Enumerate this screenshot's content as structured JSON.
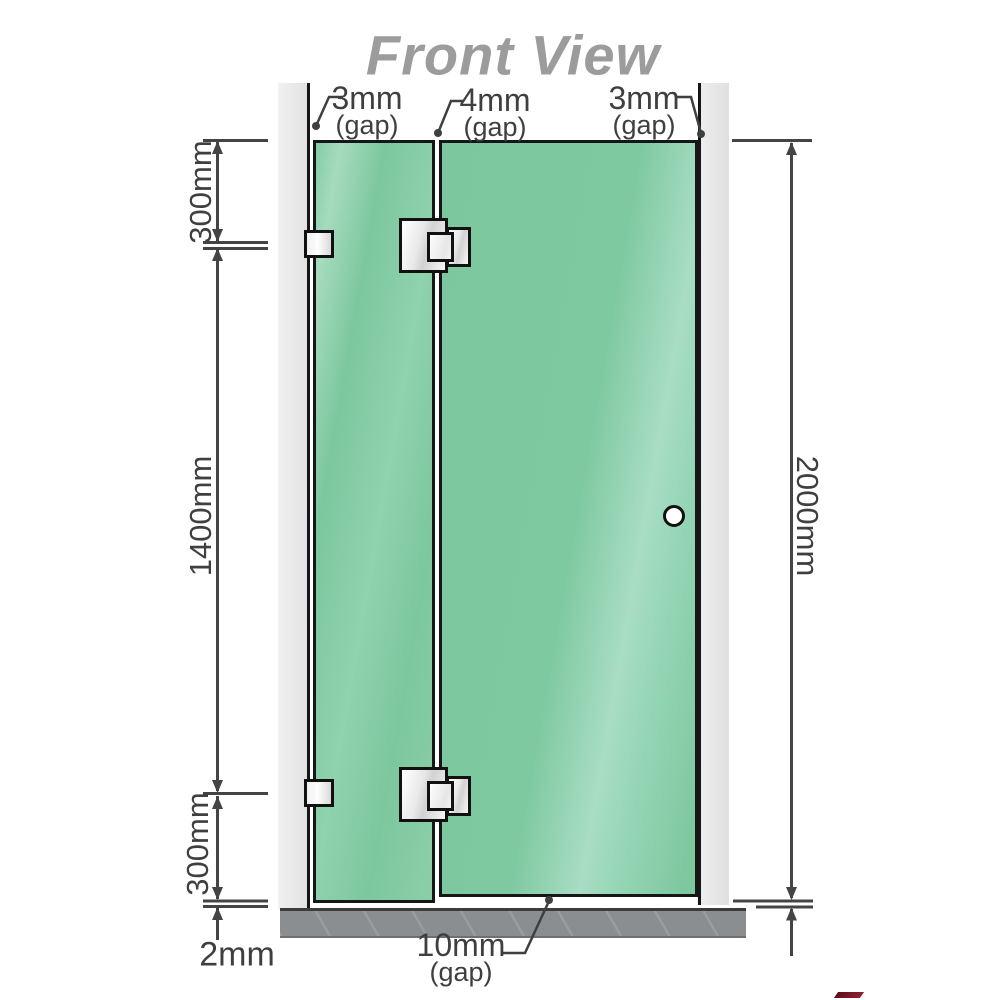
{
  "title": "Front View",
  "labels": {
    "gap_top_left": {
      "value": "3mm",
      "suffix": "(gap)"
    },
    "gap_top_middle": {
      "value": "4mm",
      "suffix": "(gap)"
    },
    "gap_top_right": {
      "value": "3mm",
      "suffix": "(gap)"
    },
    "gap_bottom": {
      "value": "10mm",
      "suffix": "(gap)"
    },
    "dim_left_top": "300mm",
    "dim_left_middle": "1400mm",
    "dim_left_bottom": "300mm",
    "dim_right": "2000mm",
    "dim_base": "2mm"
  },
  "hardware": {
    "hinge_count": 2,
    "wall_bracket_count": 2,
    "knob_count": 1
  },
  "colors": {
    "glass": "#7ec8a0",
    "glass_highlight": "#a8ddc3",
    "wall": "#e9e9e9",
    "base": "#8b8e91",
    "outline": "#161616",
    "dim_line": "#444444",
    "text": "#3f3f3f",
    "title": "#9c9c9c",
    "hardware_fill": "#f2f2f2",
    "logo_red": "#8c2233"
  }
}
